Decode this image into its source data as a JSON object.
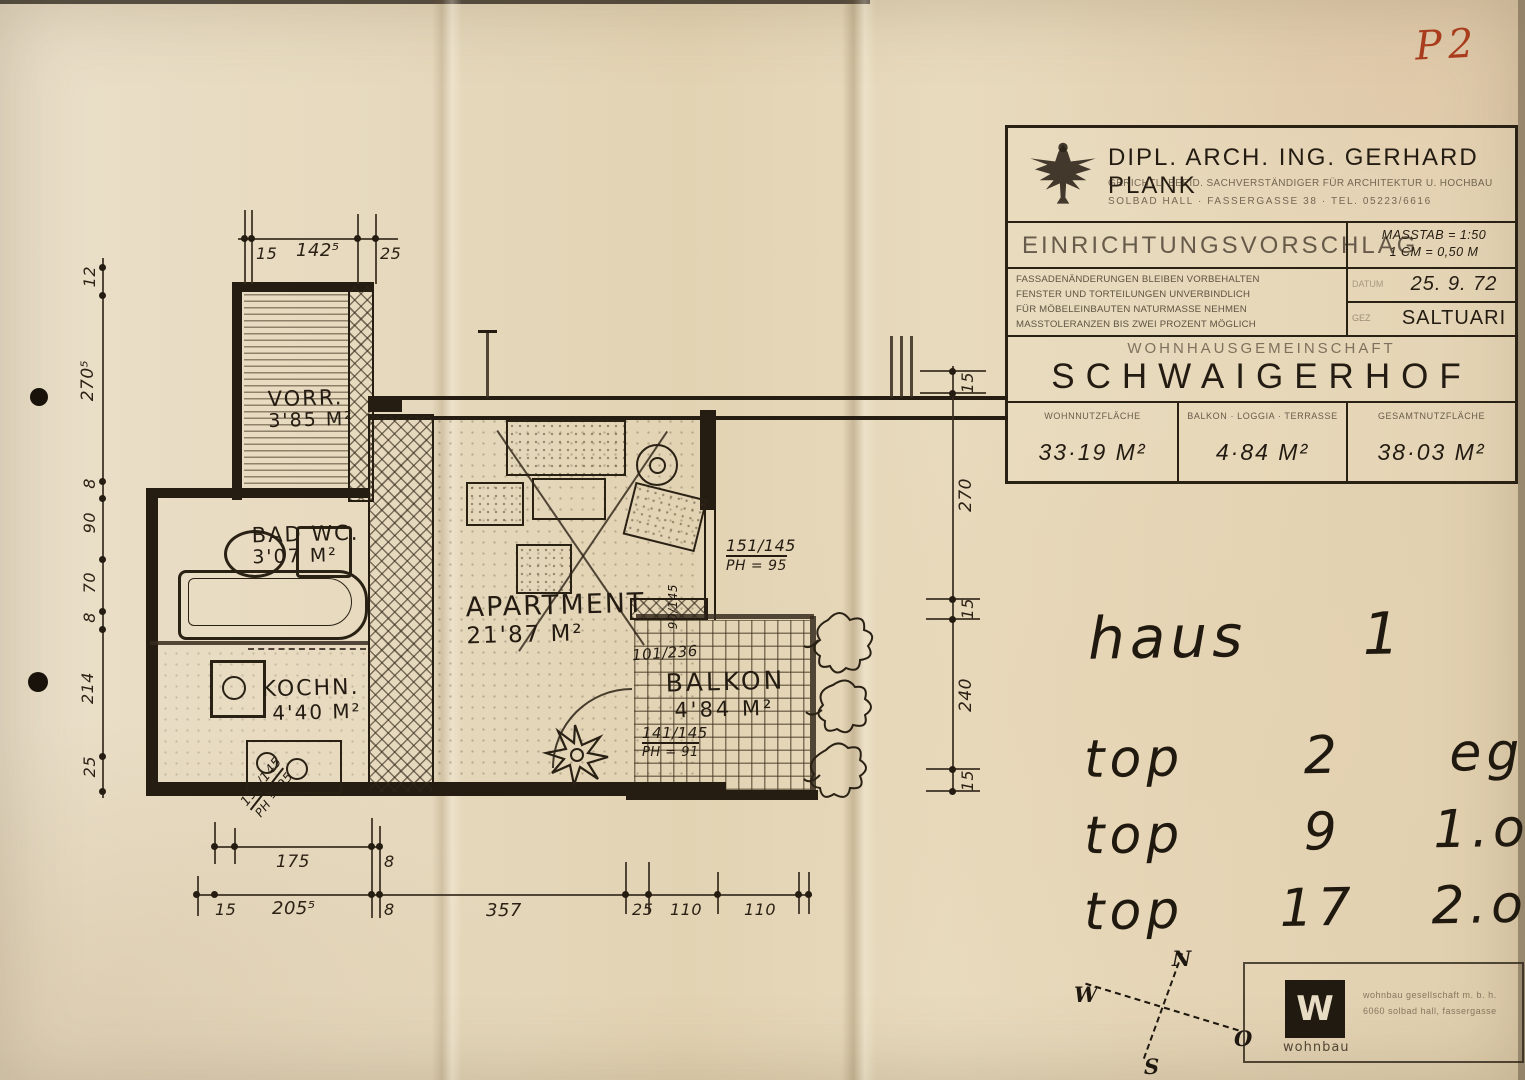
{
  "page": {
    "mark": "P2"
  },
  "title_block": {
    "architect_name": "DIPL. ARCH. ING. GERHARD PLANK",
    "architect_line2": "GERICHTL. BEEID. SACHVERSTÄNDIGER FÜR ARCHITEKTUR U. HOCHBAU",
    "architect_line3": "SOLBAD HALL · FASSERGASSE 38 · TEL. 05223/6616",
    "proposal": "EINRICHTUNGSVORSCHLAG",
    "scale1": "MASSTAB = 1:50",
    "scale2": "1 CM = 0,50 M",
    "note1": "FASSADENÄNDERUNGEN BLEIBEN VORBEHALTEN",
    "note2": "FENSTER UND TORTEILUNGEN UNVERBINDLICH",
    "note3": "FÜR MÖBELEINBAUTEN NATURMASSE NEHMEN",
    "note4": "MASSTOLERANZEN BIS ZWEI PROZENT MÖGLICH",
    "datum_label": "DATUM",
    "datum": "25. 9. 72",
    "gez_label": "GEZ",
    "gez": "SALTUARI",
    "community": "WOHNHAUSGEMEINSCHAFT",
    "project": "SCHWAIGERHOF",
    "area1_label": "WOHNNUTZFLÄCHE",
    "area1": "33·19 M²",
    "area2_label": "BALKON · LOGGIA · TERRASSE",
    "area2": "4·84 M²",
    "area3_label": "GESAMTNUTZFLÄCHE",
    "area3": "38·03 M²"
  },
  "plan": {
    "rooms": {
      "vorr_name": "VORR.",
      "vorr_area": "3'85 M²",
      "bad_name": "BAD WC.",
      "bad_area": "3'07 M²",
      "koch_name": "KOCHN.",
      "koch_area": "4'40 M²",
      "apartment_name": "APARTMENT",
      "apartment_area": "21'87 M²",
      "balkon_name": "BALKON",
      "balkon_area": "4'84 M²"
    },
    "dims": {
      "top": [
        "15",
        "142⁵",
        "25"
      ],
      "left": [
        "12",
        "270⁵",
        "8",
        "90",
        "70",
        "8",
        "214",
        "25"
      ],
      "right": [
        "15",
        "270",
        "15",
        "240",
        "15"
      ],
      "bottom1": [
        "175",
        "8"
      ],
      "bottom2": [
        "15",
        "205⁵",
        "8",
        "357",
        "25",
        "110",
        "110"
      ]
    },
    "annotations": {
      "win1_l1": "151/145",
      "win1_l2": "PH = 95",
      "door1_l1": "141/145",
      "door1_l2": "PH = 91",
      "balcony_door": "101/236",
      "vert_win": "90/145",
      "diag_l1": "151/145",
      "diag_l2": "PH = 95"
    }
  },
  "hand": {
    "haus_label": "haus",
    "haus_number": "1",
    "rows": [
      {
        "word": "top",
        "num": "2",
        "floor": "eg."
      },
      {
        "word": "top",
        "num": "9",
        "floor": "1.og."
      },
      {
        "word": "top",
        "num": "17",
        "floor": "2.og."
      }
    ]
  },
  "compass": {
    "n": "N",
    "w": "W",
    "o": "O",
    "s": "S"
  },
  "stamp": {
    "logo_letter": "W",
    "stamp_name": "wohnbau",
    "line1": "wohnbau gesellschaft m. b. h.",
    "line2": "6060 solbad hall, fassergasse"
  }
}
